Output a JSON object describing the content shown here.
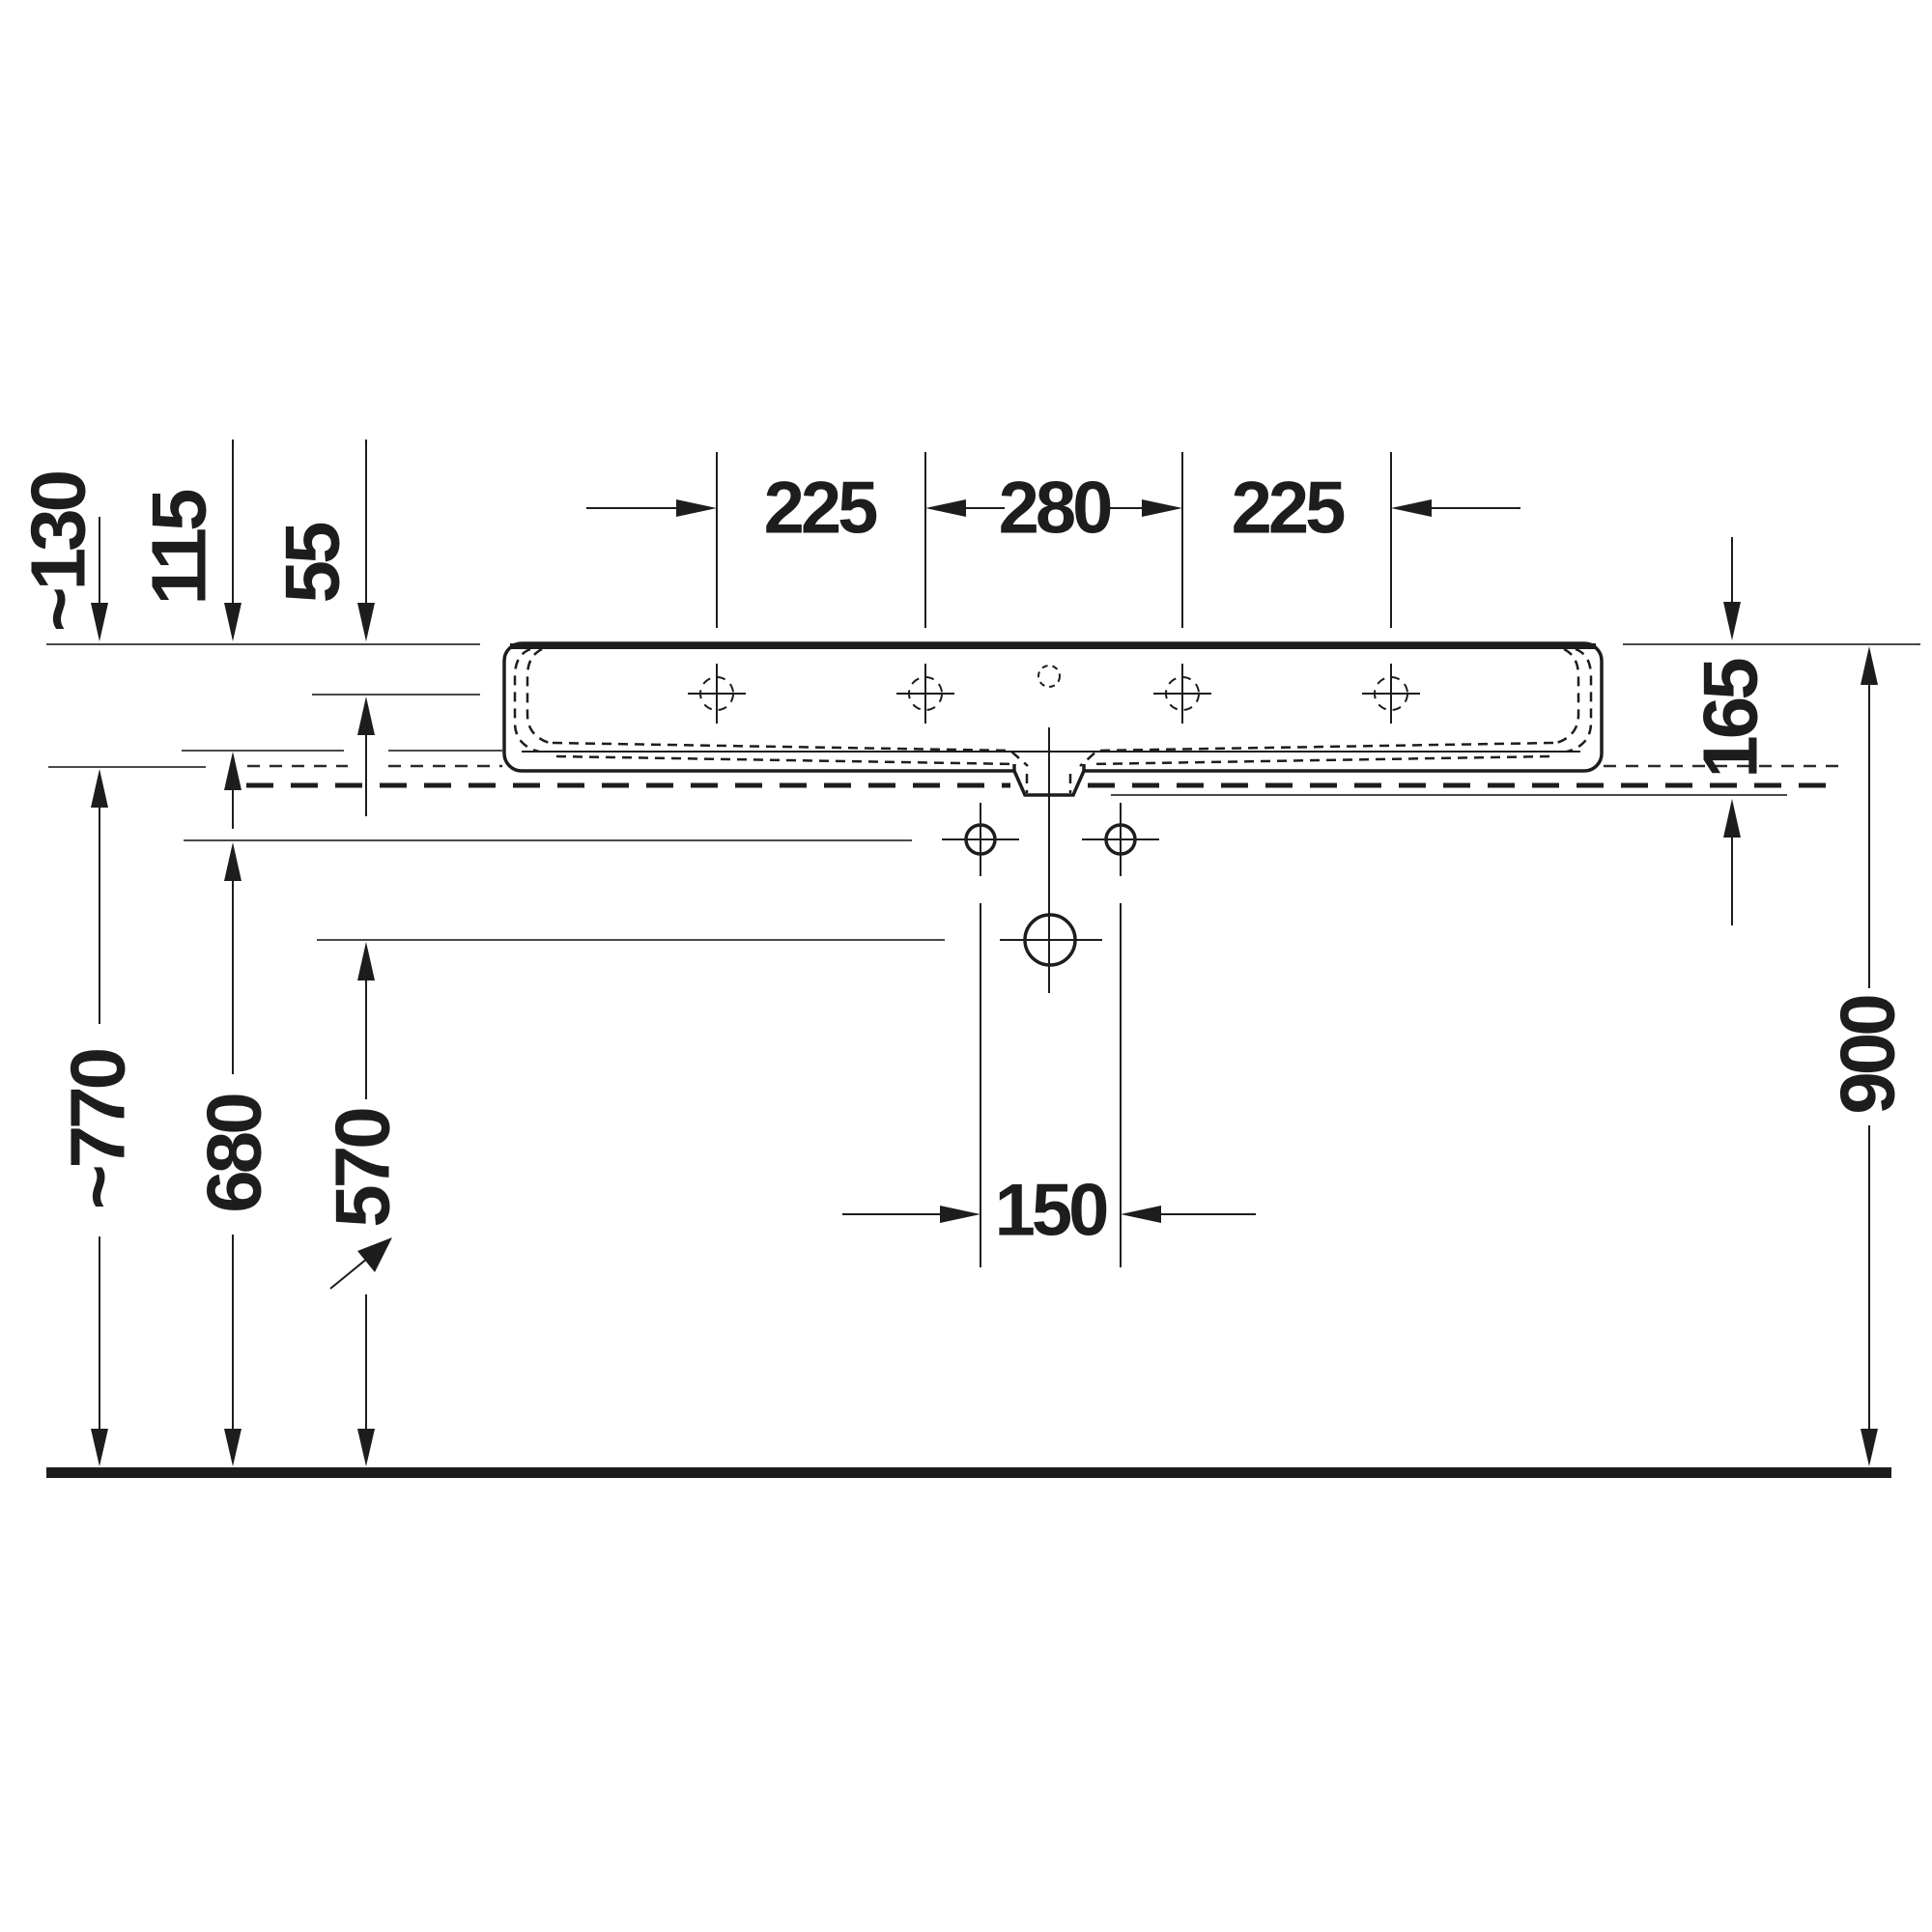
{
  "drawing": {
    "kind": "washbasin installation dimension drawing, front elevation",
    "line_color": "#1d1d1b",
    "background": "#ffffff",
    "dimensions": {
      "top_hole_spacing_left": "225",
      "top_hole_spacing_center": "280",
      "top_hole_spacing_right": "225",
      "left_rim_to_underside": "~130",
      "left_rim_to_bowl": "115",
      "left_rim_to_deck": "55",
      "right_rim_to_fixing": "165",
      "right_rim_height": "900",
      "bottom_underside_height": "~770",
      "bottom_fixing_height": "680",
      "bottom_drain_height": "570",
      "bottom_drain_bolt_spacing": "150"
    }
  }
}
